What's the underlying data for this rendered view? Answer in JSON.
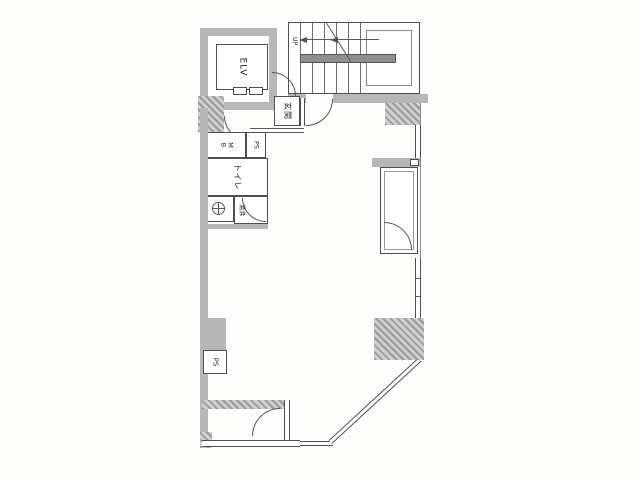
{
  "floorplan": {
    "labels": {
      "elevator": "ELV",
      "stairs_up": "UP",
      "entrance": "玄関",
      "meter_box_top": "M",
      "meter_box_bottom": "B",
      "pipe_shaft_upper": "PS",
      "toilet": "トイレ",
      "hot_water_room": "湯沸",
      "pipe_shaft_lower": "PS"
    },
    "colors": {
      "wall_gray": "#b7b7b7",
      "line": "#4f4f4f",
      "stair_landing": "#8f8f8f",
      "background": "#fdfdfb"
    }
  }
}
